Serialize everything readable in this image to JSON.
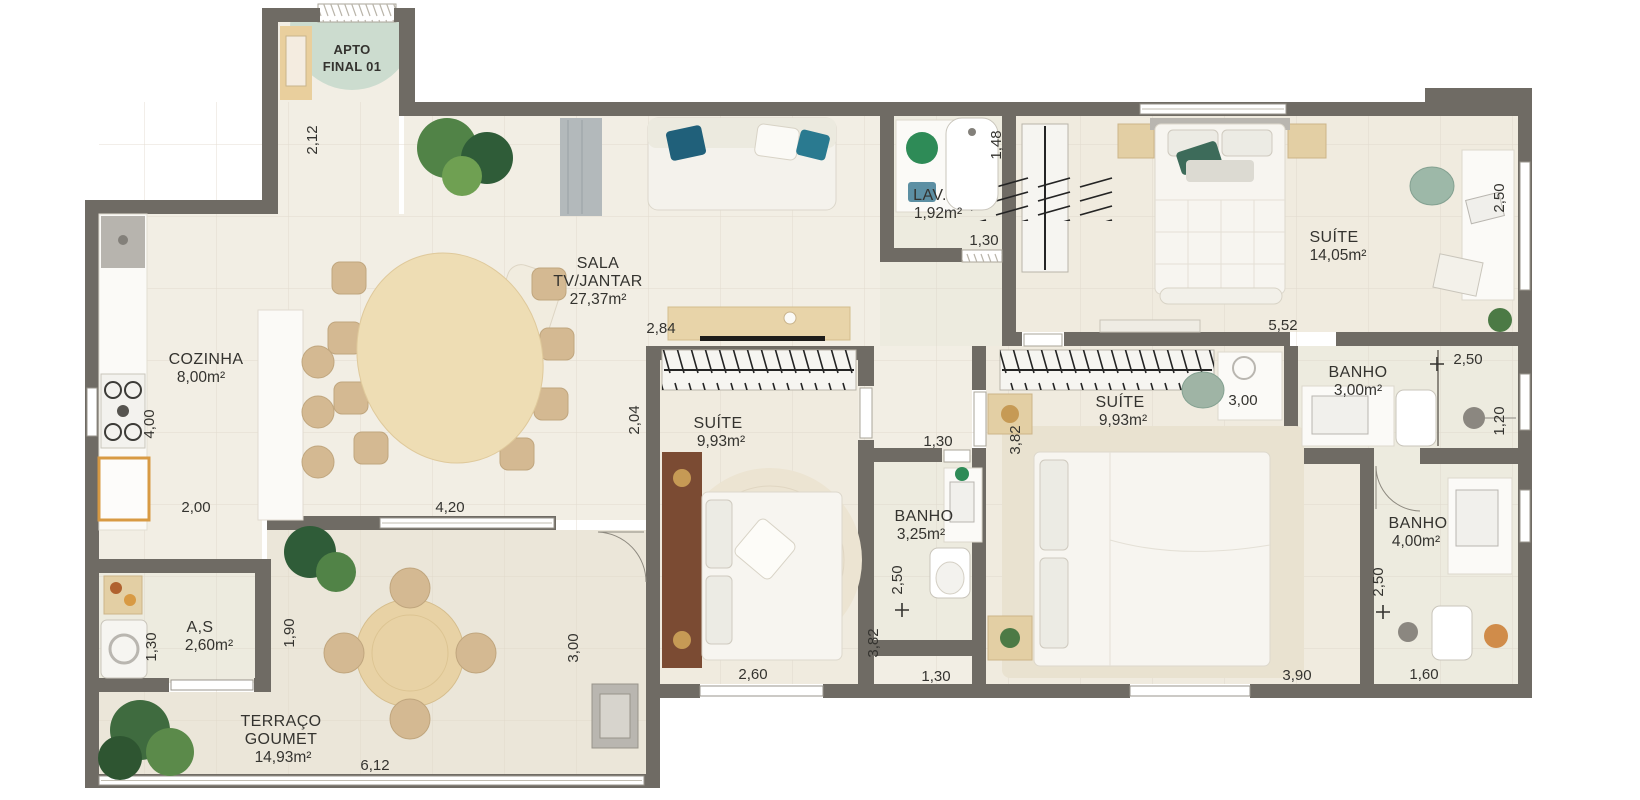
{
  "plan_badge": {
    "line1": "APTO",
    "line2": "FINAL 01"
  },
  "rooms": {
    "sala": {
      "name1": "SALA",
      "name2": "TV/JANTAR",
      "area": "27,37m²"
    },
    "cozinha": {
      "name": "COZINHA",
      "area": "8,00m²"
    },
    "lav": {
      "name": "LAV.",
      "area": "1,92m²"
    },
    "suite_master": {
      "name": "SUÍTE",
      "area": "14,05m²"
    },
    "suite_2": {
      "name": "SUÍTE",
      "area": "9,93m²"
    },
    "suite_3": {
      "name": "SUÍTE",
      "area": "9,93m²"
    },
    "banho_corredor": {
      "name": "BANHO",
      "area": "3,25m²"
    },
    "banho_master": {
      "name": "BANHO",
      "area": "3,00m²"
    },
    "banho_suite3": {
      "name": "BANHO",
      "area": "4,00m²"
    },
    "area_servico": {
      "name": "A,S",
      "area": "2,60m²"
    },
    "terraco": {
      "name1": "TERRAÇO",
      "name2": "GOUMET",
      "area": "14,93m²"
    }
  },
  "dimensions": {
    "entry_depth": "2,12",
    "sala_sideboard": "2,84",
    "cozinha_depth": "4,00",
    "cozinha_width": "2,00",
    "sala_width": "4,20",
    "lav_depth": "1,48",
    "lav_width": "1,30",
    "suite_master_width": "5,52",
    "suite_master_depth": "2,50",
    "suite3_desk": "3,00",
    "suite2_depth": "2,04",
    "suite3_depth": "3,82",
    "suite2_side": "3,82",
    "banho_corredor_width": "1,30",
    "banho_corredor_depth": "2,50",
    "banho_corredor_bottom": "1,30",
    "suite2_width": "2,60",
    "suite3_width": "3,90",
    "banho_suite3_width": "1,60",
    "banho_suite3_depth": "2,50",
    "banho_master_width": "2,50",
    "banho_master_depth": "1,20",
    "as_depth": "1,30",
    "as_side": "1,90",
    "terraco_depth": "3,00",
    "terraco_width": "6,12"
  },
  "colors": {
    "wall": "#6f6b64",
    "floor": "#f2eee4",
    "floor_wet": "#edebdf",
    "floor_terrace": "#ebe6d9",
    "badge": "#ccdccf",
    "wood": "#ecdcb2",
    "chair": "#d4b992",
    "teal": "#20607a",
    "headboard": "#7b4b33",
    "plant": "#4c7a45"
  }
}
